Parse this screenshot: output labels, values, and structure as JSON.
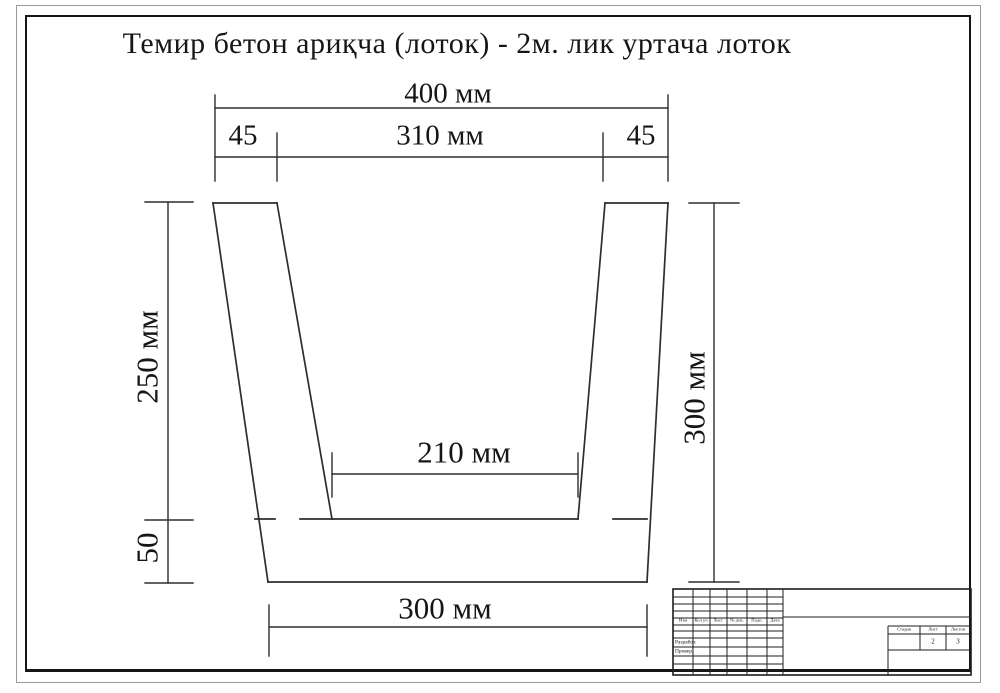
{
  "page": {
    "title": "Темир бетон ариқча (лоток) - 2м. лик уртача лоток"
  },
  "dims": {
    "top_width": "400 мм",
    "side_top_left": "45",
    "inner_top": "310 мм",
    "side_top_right": "45",
    "wall_height": "250 мм",
    "base_thickness": "50",
    "total_height": "300 мм",
    "inner_bottom": "210 мм",
    "bottom_width": "300 мм"
  },
  "title_block": {
    "revision_headers": [
      "Изм",
      "Кол.уч",
      "Лист",
      "№ док.",
      "Подп.",
      "Дата"
    ],
    "row_labels": {
      "developed": "Разработ.",
      "checked": "Провер."
    },
    "stage": {
      "label": "Стадия",
      "value": ""
    },
    "sheet": {
      "label": "Лист",
      "value": "2"
    },
    "sheets": {
      "label": "Листов",
      "value": "3"
    }
  }
}
